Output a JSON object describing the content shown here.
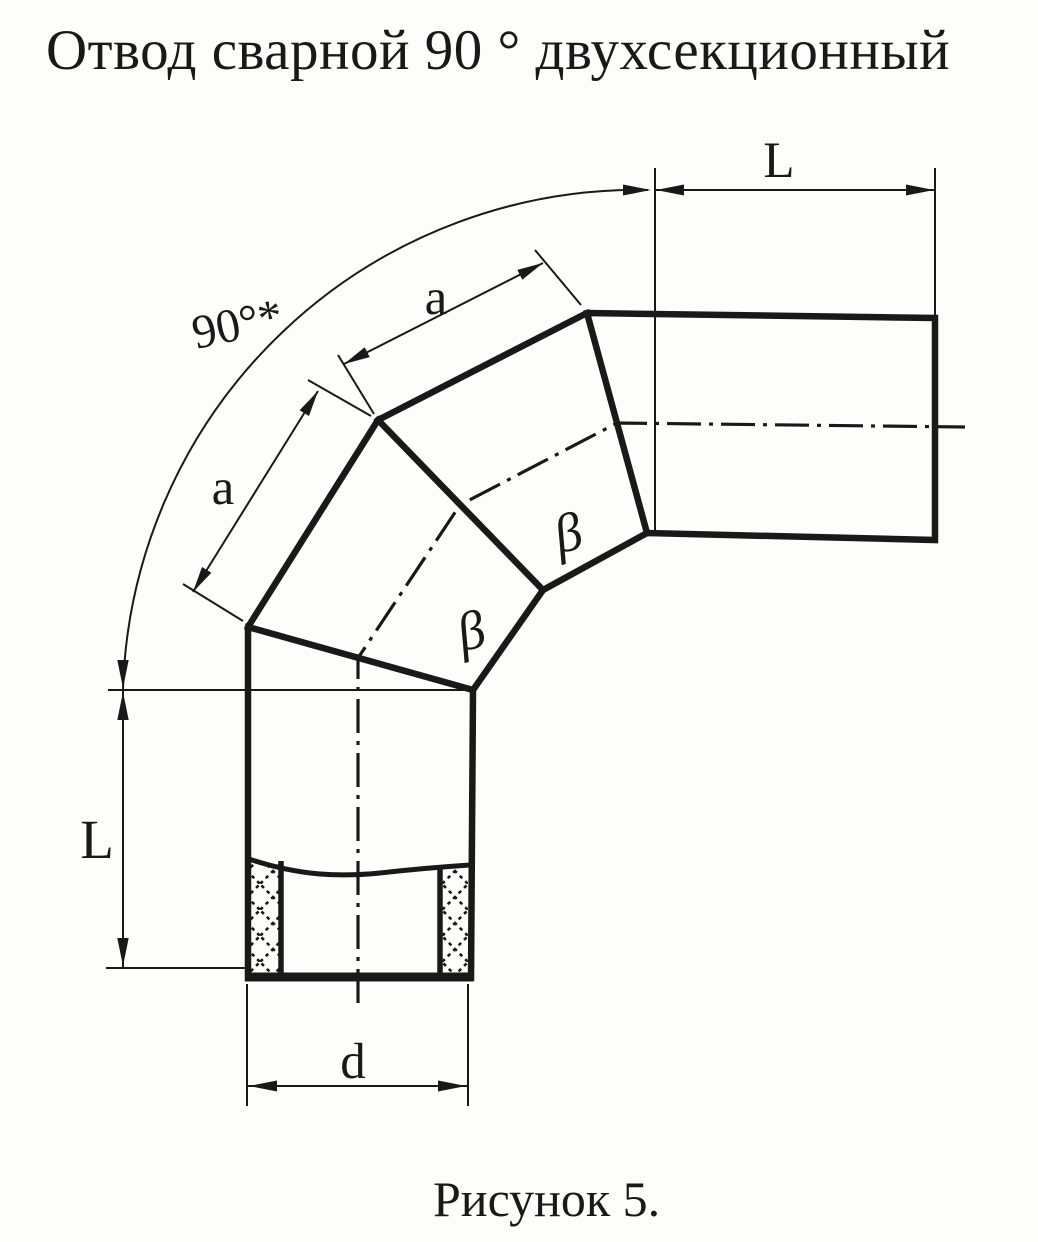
{
  "title": "Отвод сварной 90 ° двухсекционный",
  "caption": "Рисунок 5.",
  "colors": {
    "ink": "#191919",
    "paper": "#fdfdfc"
  },
  "drawing": {
    "angle_label": "90°*",
    "top_length_label": "L",
    "left_length_label": "L",
    "upper_segment_width_label": "a",
    "lower_segment_width_label": "a",
    "diameter_label": "d",
    "upper_segment_angle_symbol": "β",
    "lower_segment_angle_symbol": "β"
  }
}
